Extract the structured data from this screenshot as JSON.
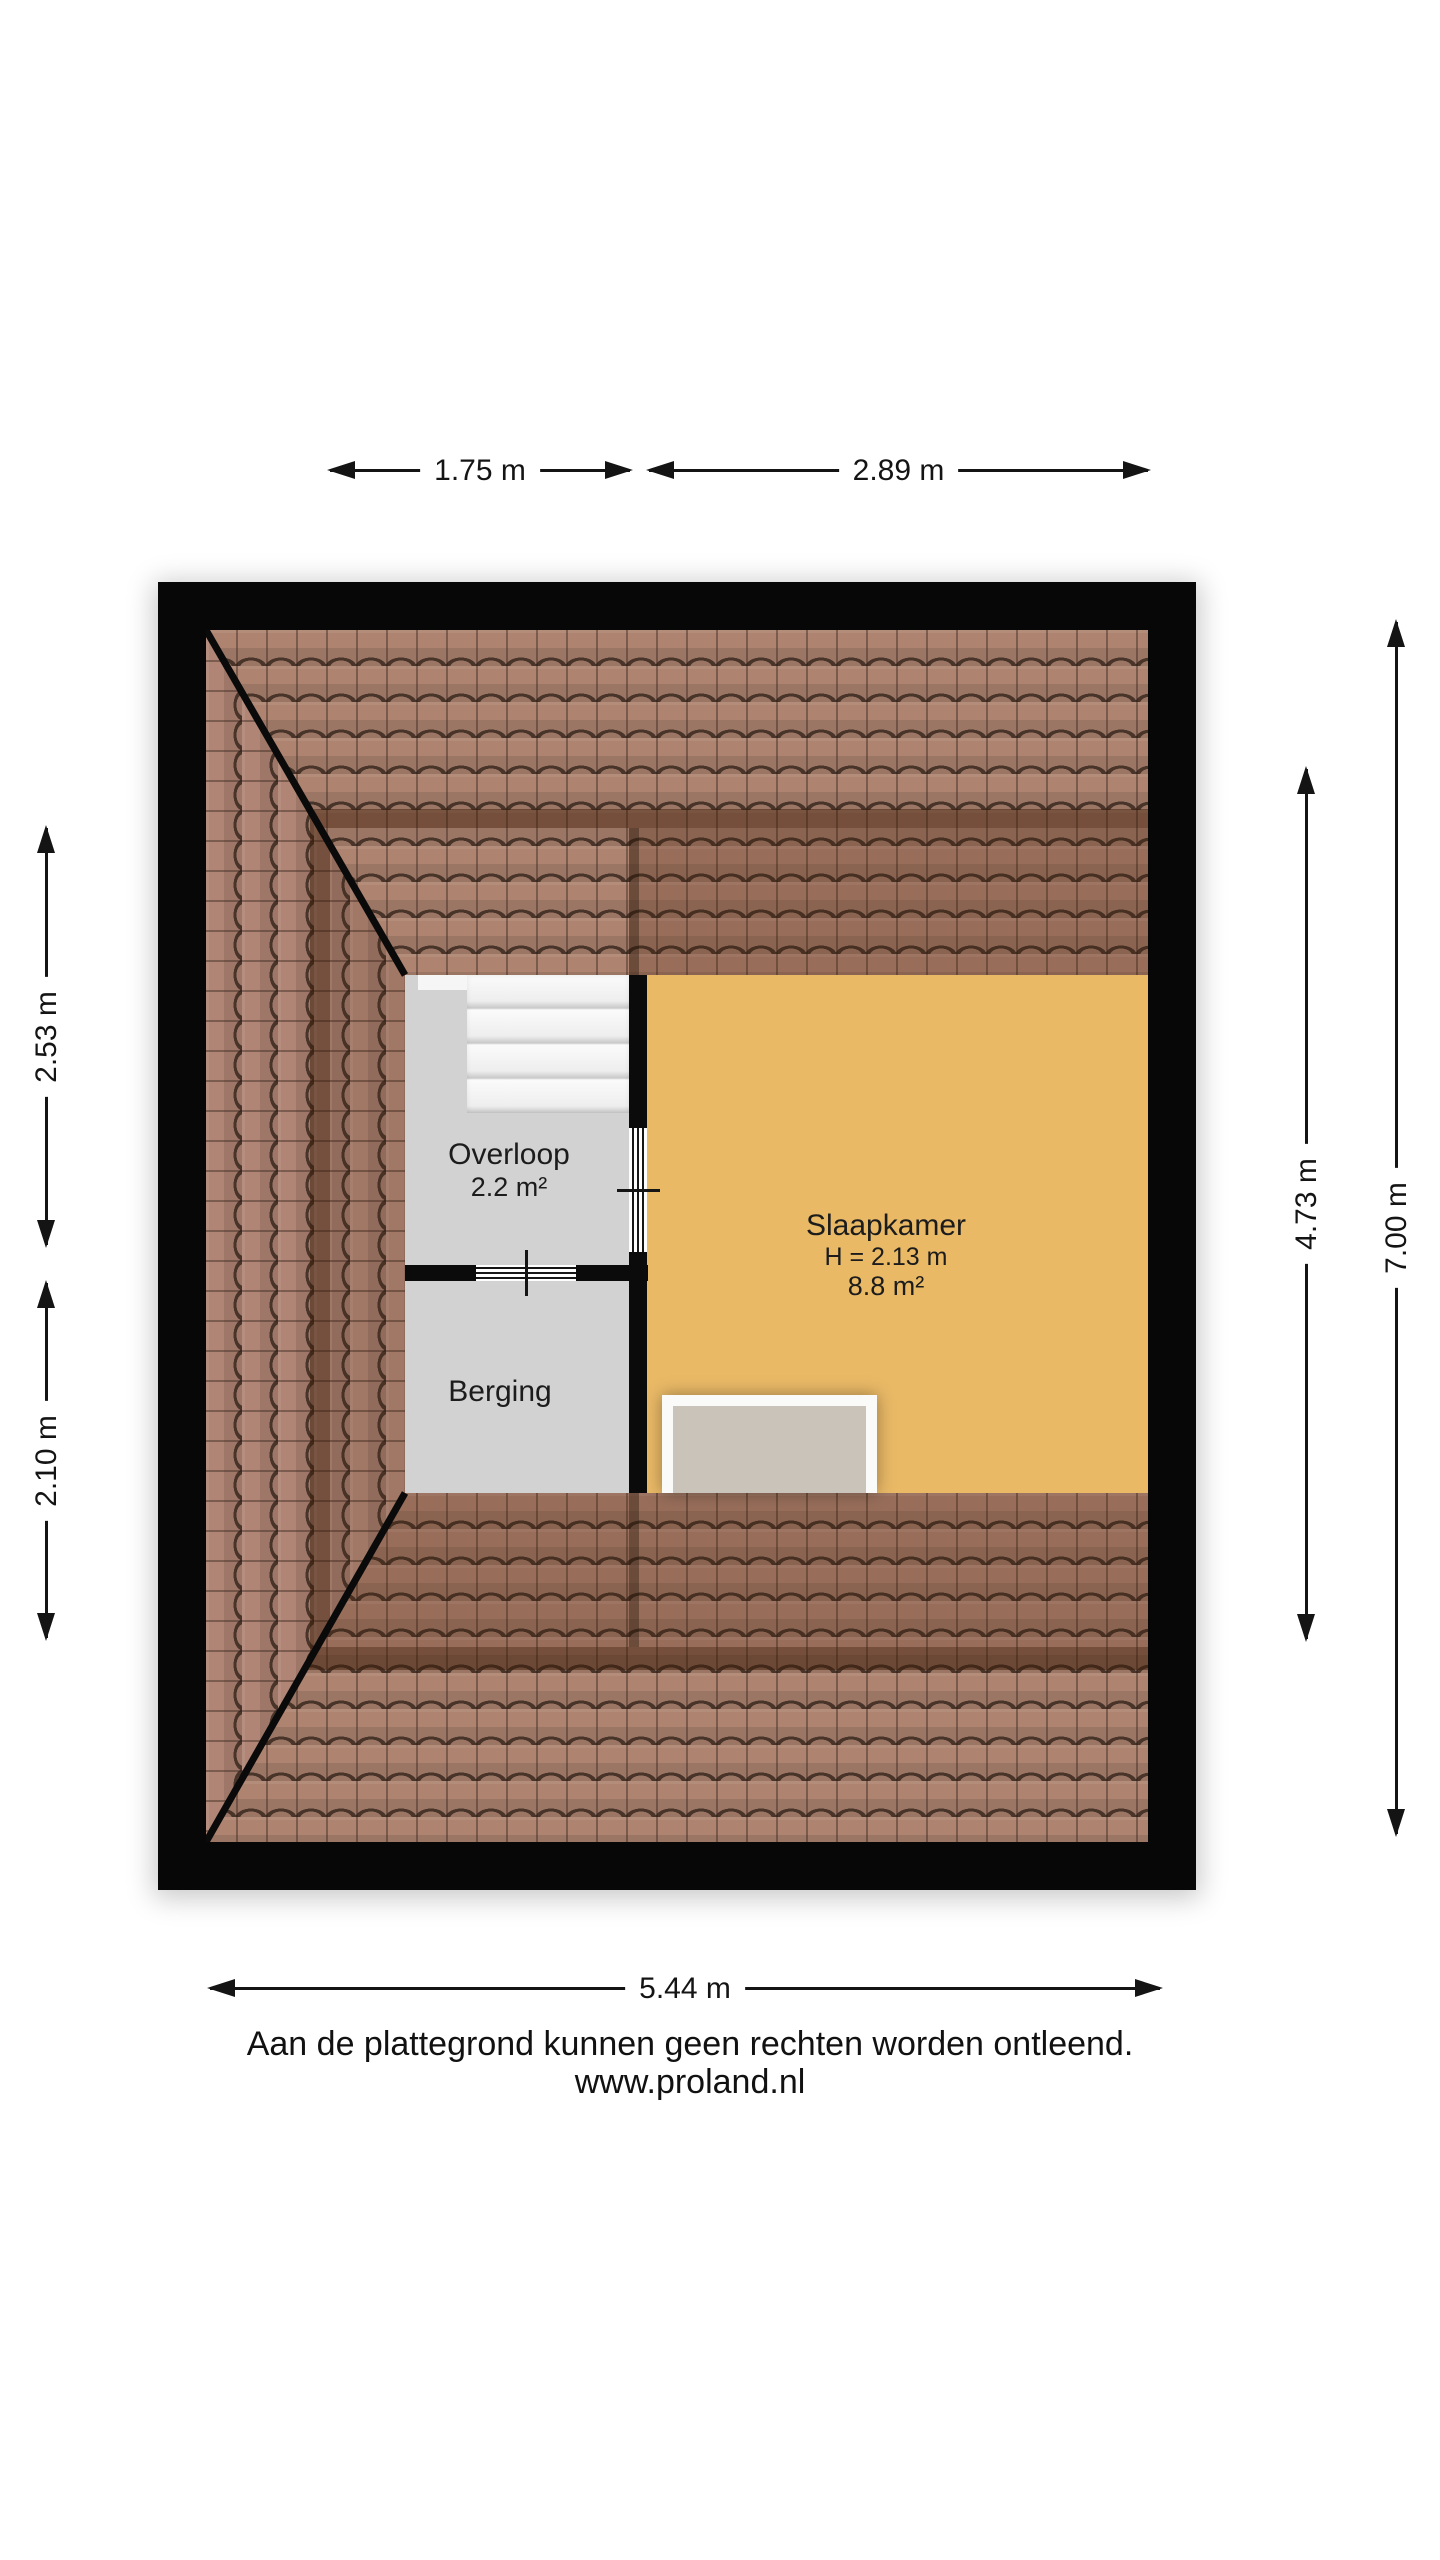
{
  "rooms": {
    "overloop": {
      "name": "Overloop",
      "area": "2.2 m²"
    },
    "berging": {
      "name": "Berging"
    },
    "slaapkamer": {
      "name": "Slaapkamer",
      "ceiling_height": "H = 2.13 m",
      "area": "8.8 m²"
    }
  },
  "dimensions": {
    "top_left": "1.75 m",
    "top_right": "2.89 m",
    "left_upper": "2.53 m",
    "left_lower": "2.10 m",
    "right_inner": "4.73 m",
    "right_outer": "7.00 m",
    "bottom": "5.44 m"
  },
  "footer": {
    "disclaimer": "Aan de plattegrond kunnen geen rechten worden ontleend.",
    "website": "www.proland.nl"
  },
  "colors": {
    "wall": "#0b0b0b",
    "roof_tile": "#ae8370",
    "floor_wood": "#e9b966",
    "floor_gray": "#d2d2d2",
    "knee_wall_band": "rgba(60,27,8,0.5)"
  }
}
